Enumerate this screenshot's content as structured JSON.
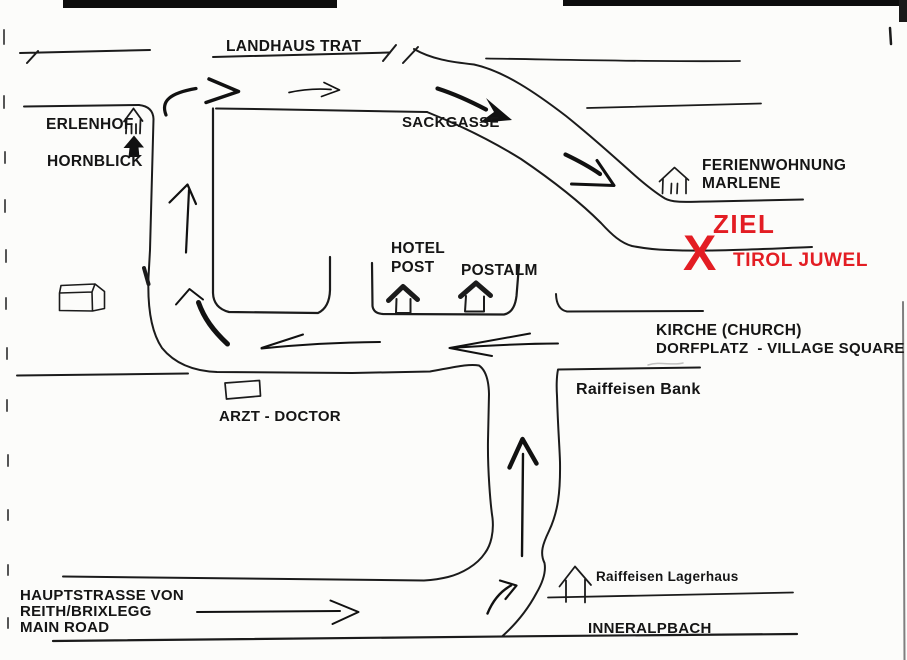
{
  "document": {
    "kind": "scanned hand-drawn directions map",
    "destination": {
      "goal_word": "ZIEL",
      "marker": "X",
      "name": "TIROL JUWEL"
    }
  },
  "colors": {
    "ink": "#1b1b1b",
    "label_text": "#151515",
    "highlight_red": "#e31d23",
    "paper": "#fcfcfa",
    "scan_artifact": "#0d0d0d"
  },
  "labels": {
    "landhaus_trat": "LANDHAUS TRAT",
    "erlenhof": "ERLENHOF",
    "hornblick": "HORNBLICK",
    "sackgasse": "SACKGASSE",
    "ferienwohnung_line1": "FERIENWOHNUNG",
    "ferienwohnung_line2": "MARLENE",
    "ziel": "ZIEL",
    "x_marker": "X",
    "tirol_juwel": "TIROL JUWEL",
    "hotel_line1": "HOTEL",
    "hotel_line2": "POST",
    "postalm": "POSTALM",
    "kirche": "KIRCHE (CHURCH)",
    "dorfplatz": "DORFPLATZ  - VILLAGE SQUARE",
    "raiffeisen_bank": "Raiffeisen Bank",
    "arzt": "ARZT - DOCTOR",
    "hauptstrasse_line1": "HAUPTSTRASSE VON",
    "hauptstrasse_line2": "REITH/BRIXLEGG",
    "hauptstrasse_line3": "MAIN ROAD",
    "raiffeisen_lagerhaus": "Raiffeisen Lagerhaus",
    "inneralpbach": "INNERALPBACH"
  },
  "icons": {
    "erlenhof_icon": "house-outline-icon",
    "hornblick_icon": "house-filled-icon",
    "barn_icon": "barn-3d-sketch-icon",
    "hotel_post_icon": "bold-roof-house-icon",
    "postalm_icon": "bold-roof-house-icon",
    "ferienwohnung_icon": "house-outline-icon",
    "lagerhaus_icon": "open-house-outline-icon",
    "arzt_icon": "rectangle-building-icon",
    "route_arrows": "hand-drawn-direction-arrows"
  }
}
